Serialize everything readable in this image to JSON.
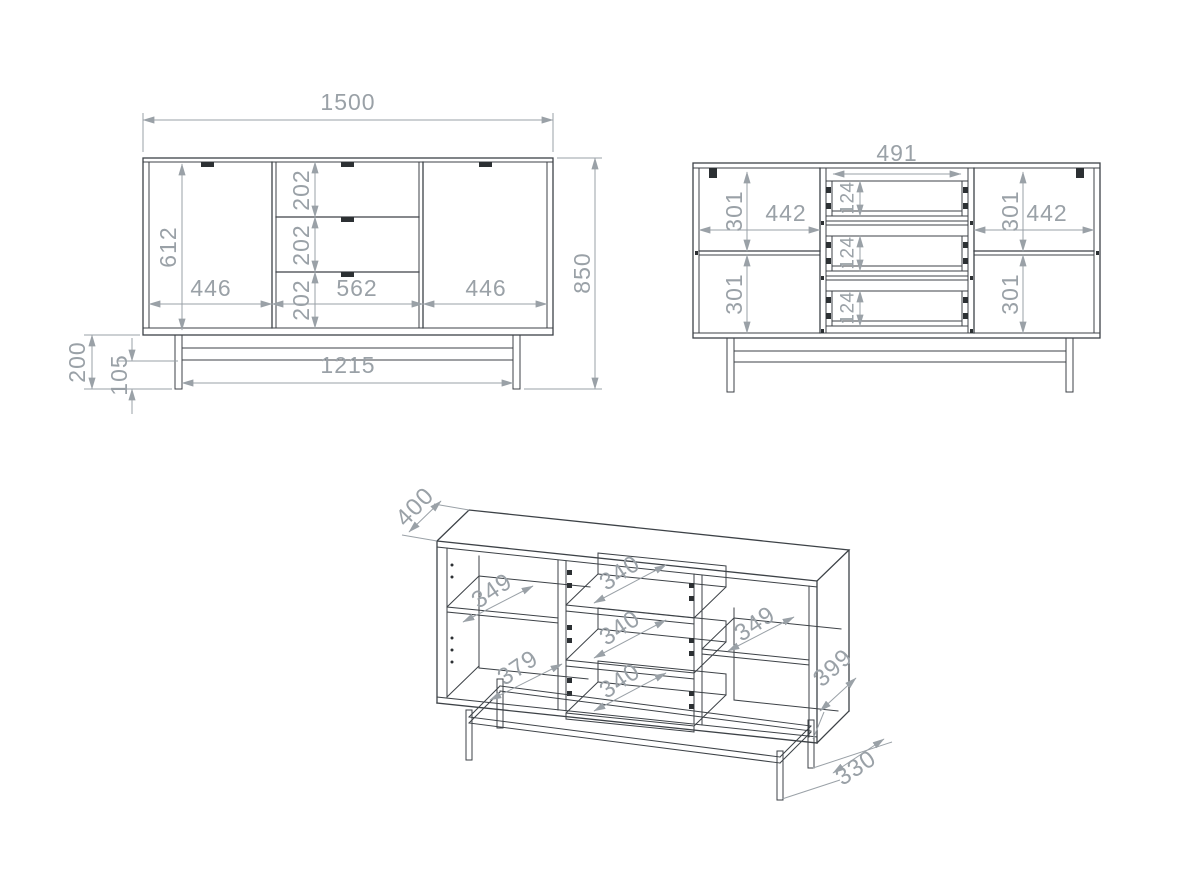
{
  "drawing": {
    "type": "furniture-technical-drawing",
    "background": "#ffffff",
    "outline_color": "#3d4247",
    "dimension_color": "#9aa1a7"
  },
  "dims": {
    "front": {
      "overall_width": "1500",
      "overall_height": "850",
      "door_height": "612",
      "drawer_front_top": "202",
      "drawer_front_middle": "202",
      "drawer_front_bottom": "202",
      "left_door_width": "446",
      "drawer_section_width": "562",
      "right_door_width": "446",
      "leg_height": "200",
      "rail_clearance": "105",
      "base_width": "1215"
    },
    "internal": {
      "drawer_opening_width": "491",
      "left_top_height": "301",
      "left_width": "442",
      "left_bottom_height": "301",
      "right_top_height": "301",
      "right_width": "442",
      "right_bottom_height": "301",
      "drawer_box_top": "124",
      "drawer_box_middle": "124",
      "drawer_box_bottom": "124"
    },
    "perspective": {
      "depth": "400",
      "left_shelf_depth": "349",
      "left_bottom_depth": "379",
      "drawer_depth_top": "340",
      "drawer_depth_middle": "340",
      "drawer_depth_bottom": "340",
      "right_shelf_depth": "349",
      "side_panel_depth": "399",
      "base_frame_depth": "330"
    }
  }
}
